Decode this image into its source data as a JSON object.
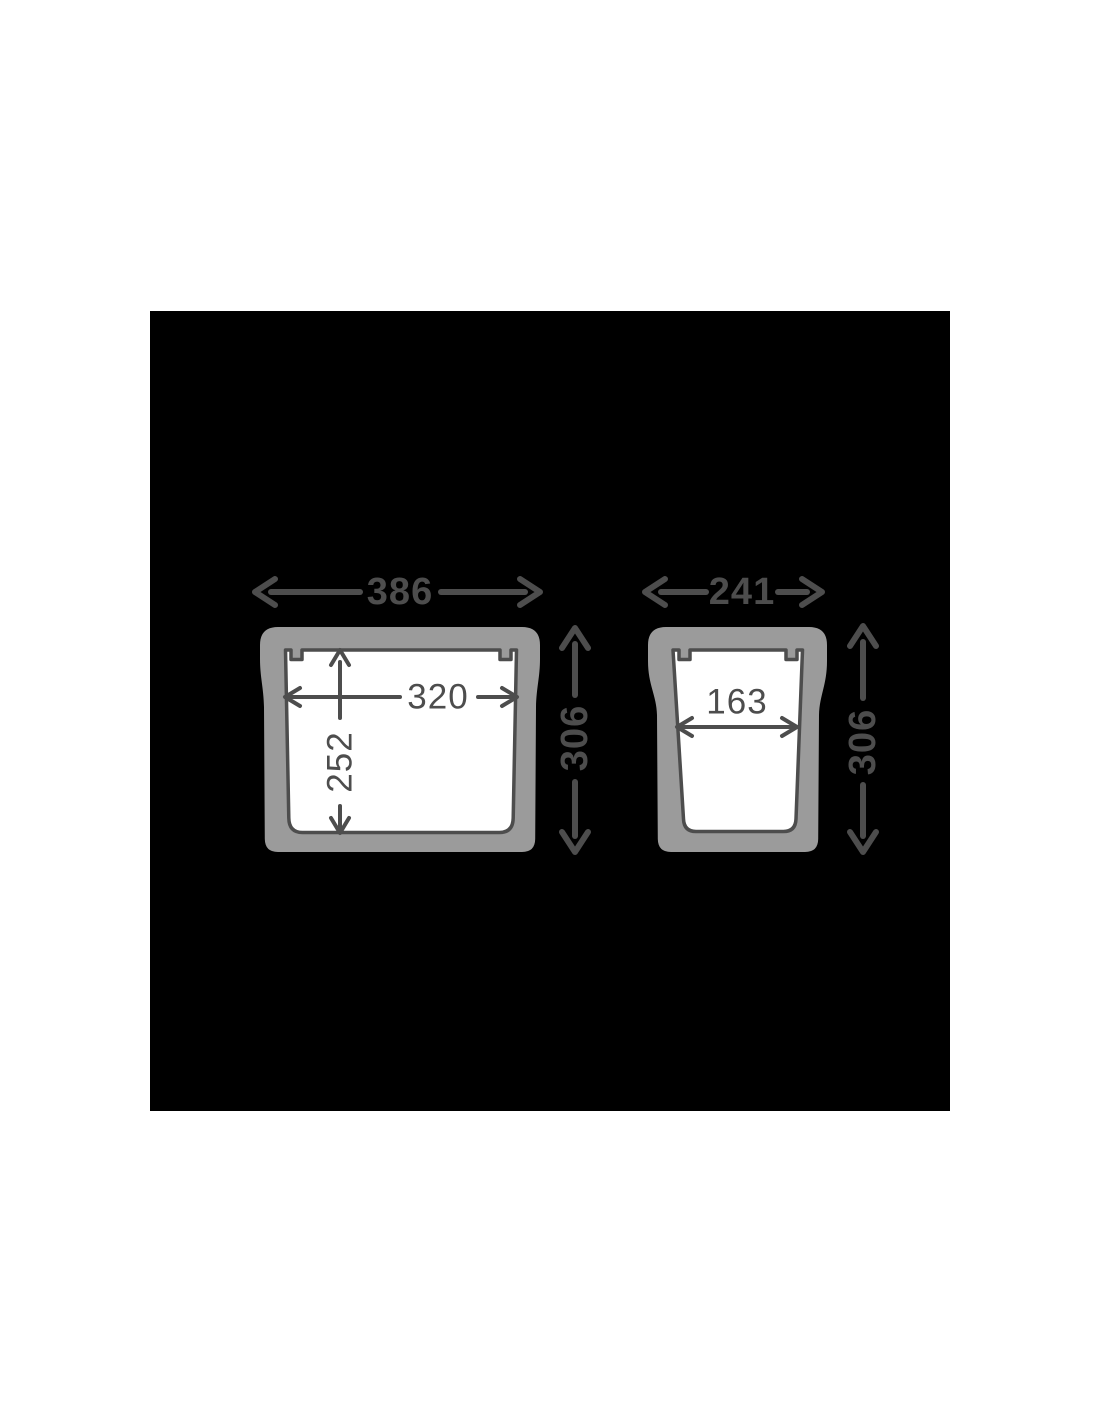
{
  "scene": {
    "description": "Cross-section dimension drawing of two cooler boxes",
    "background_color": "#ffffff",
    "panel_color": "#000000",
    "box_body_color": "#9b9b9b",
    "cavity_color": "#ffffff",
    "line_color": "#4d4d4d"
  },
  "large_box": {
    "outer_width": "386",
    "inner_width": "320",
    "inner_depth": "252",
    "outer_height": "306"
  },
  "small_box": {
    "outer_width": "241",
    "inner_width": "163",
    "outer_height": "306"
  }
}
